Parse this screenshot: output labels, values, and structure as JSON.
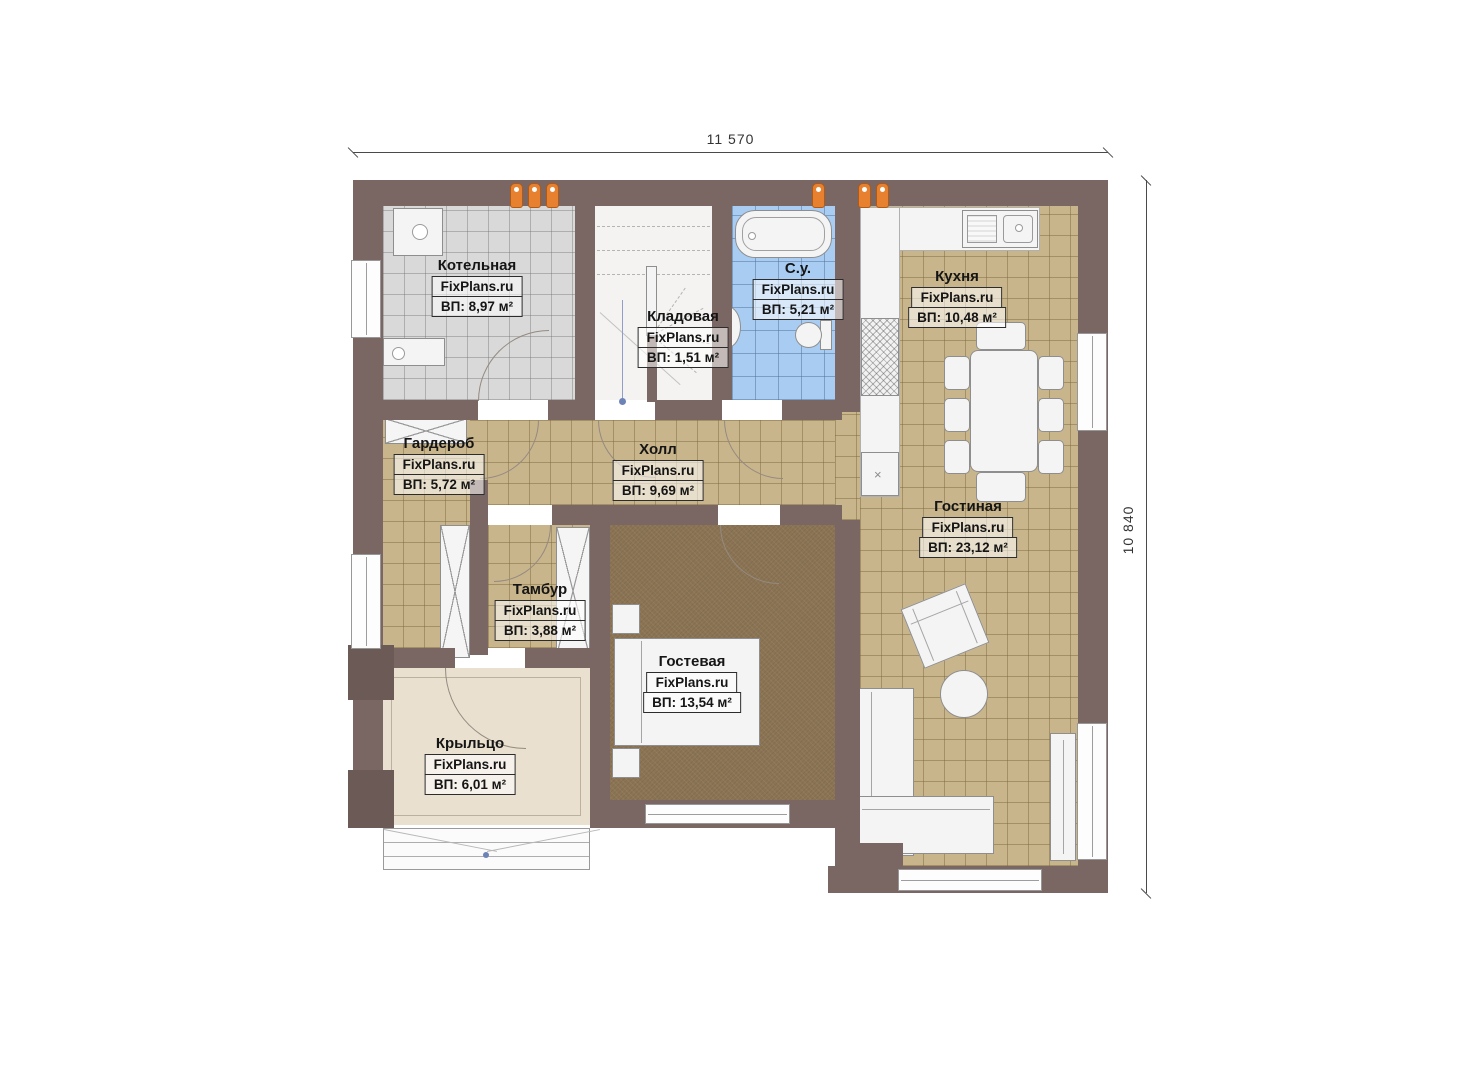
{
  "plan_title": "First floor plan",
  "brand": "FixPlans.ru",
  "dimensions": {
    "width_label": "11 570",
    "height_label": "10 840"
  },
  "rooms": [
    {
      "name": "Котельная",
      "brand": "FixPlans.ru",
      "area": "ВП: 8,97 м²"
    },
    {
      "name": "Кладовая",
      "brand": "FixPlans.ru",
      "area": "ВП: 1,51 м²"
    },
    {
      "name": "С.у.",
      "brand": "FixPlans.ru",
      "area": "ВП: 5,21 м²"
    },
    {
      "name": "Кухня",
      "brand": "FixPlans.ru",
      "area": "ВП: 10,48 м²"
    },
    {
      "name": "Гардероб",
      "brand": "FixPlans.ru",
      "area": "ВП: 5,72 м²"
    },
    {
      "name": "Холл",
      "brand": "FixPlans.ru",
      "area": "ВП: 9,69 м²"
    },
    {
      "name": "Тамбур",
      "brand": "FixPlans.ru",
      "area": "ВП: 3,88 м²"
    },
    {
      "name": "Гостиная",
      "brand": "FixPlans.ru",
      "area": "ВП: 23,12 м²"
    },
    {
      "name": "Гостевая",
      "brand": "FixPlans.ru",
      "area": "ВП: 13,54 м²"
    },
    {
      "name": "Крыльцо",
      "brand": "FixPlans.ru",
      "area": "ВП: 6,01 м²"
    }
  ],
  "colors": {
    "wall": "#7a6662",
    "tile_beige": "#c9b58c",
    "tile_gray": "#d9d9d9",
    "tile_blue": "#a9cdf2",
    "carpet_brown": "#8b7454",
    "porch_floor": "#eae0d0",
    "vent_orange": "#e8812f",
    "furniture_white": "#f4f4f4"
  }
}
